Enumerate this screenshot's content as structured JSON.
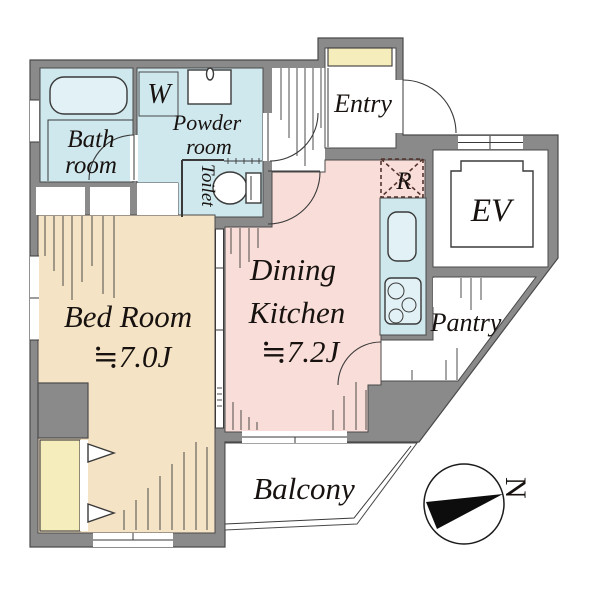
{
  "plan": {
    "rooms": {
      "bath": {
        "line1": "Bath",
        "line2": "room"
      },
      "powder": {
        "line1": "Powder",
        "line2": "room"
      },
      "toilet": {
        "label": "Toilet"
      },
      "washer": {
        "label": "W"
      },
      "entry": {
        "label": "Entry"
      },
      "fridge": {
        "label": "R"
      },
      "elevator": {
        "label": "EV"
      },
      "dk": {
        "line1": "Dining",
        "line2": "Kitchen",
        "size": "≒7.2J"
      },
      "bedroom": {
        "label": "Bed Room",
        "size": "≒7.0J"
      },
      "pantry": {
        "label": "Pantry"
      },
      "balcony": {
        "label": "Balcony"
      }
    },
    "compass": {
      "north_label": "N"
    },
    "colors": {
      "wall": "#8a8a8a",
      "wet_rooms": "#cfe8ee",
      "bedroom": "#f5e3c6",
      "dining_kitchen": "#f9ddd8",
      "closet": "#f5edbb",
      "fridge_dash": "#54342e",
      "line": "#3a3a3a"
    }
  }
}
